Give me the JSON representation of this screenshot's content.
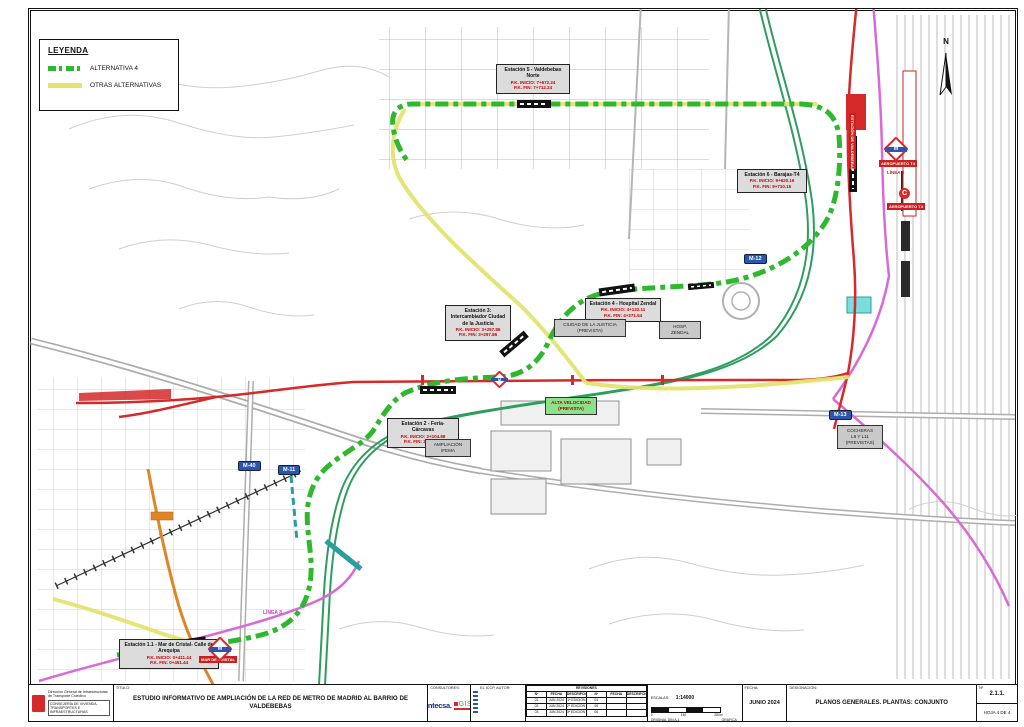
{
  "legend": {
    "title": "LEYENDA",
    "alternativa4": "ALTERNATIVA 4",
    "otras_alternativas": "OTRAS ALTERNATIVAS"
  },
  "stations": {
    "s1": {
      "title": "Estación 1.1 - Mar de Cristal- Calle de Arequipa",
      "pk_inicio": "P.K. INICIO: 0+411.44",
      "pk_fin": "P.K. FIN: 0+451.44"
    },
    "s2": {
      "title": "Estación 2 - Feria-Cárcavas",
      "pk_inicio": "P.K. INICIO: 2+104.88",
      "pk_fin": "P.K. FIN: 2+144.88"
    },
    "s3": {
      "title": "Estación 3: Intercambiador Ciudad de la Justicia",
      "pk_inicio": "P.K. INICIO: 3+257.86",
      "pk_fin": "P.K. FIN: 3+297.86"
    },
    "s4": {
      "title": "Estación 4 - Hospital Zendal",
      "pk_inicio": "P.K. INICIO: 4+132.11",
      "pk_fin": "P.K. FIN: 4+271.54"
    },
    "s5": {
      "title": "Estación 5 - Valdebebas Norte",
      "pk_inicio": "P.K. INICIO: 7+672.24",
      "pk_fin": "P.K. FIN: 7+712.24"
    },
    "s6": {
      "title": "Estación 6 - Barajas-T4",
      "pk_inicio": "P.K. INICIO: 9+620.16",
      "pk_fin": "P.K. FIN: 9+710.16"
    }
  },
  "info_boxes": {
    "ciudad_justicia": {
      "l1": "CIUDAD DE LA JUSTICIA",
      "l2": "(PREVISTA)"
    },
    "hosp_zendal": {
      "l1": "HOSP.",
      "l2": "ZENDAL"
    },
    "alta_velocidad": {
      "l1": "ALTA VELOCIDAD",
      "l2": "(PREVISTA)"
    },
    "ampliacion_ifema": {
      "l1": "AMPLIACIÓN",
      "l2": "IFEMA"
    },
    "cocheras": {
      "l1": "COCHERAS",
      "l2": "L8 Y L11",
      "l3": "(PREVISTAS)"
    }
  },
  "badges": {
    "m40": "M-40",
    "m11": "M-11",
    "m12": "M-12",
    "m13": "M-13"
  },
  "map_labels": {
    "linea8_left": "LÍNEA 8",
    "linea8_right": "LÍNEA 8",
    "aeropuerto_t4_metro": "AEROPUERTO T4",
    "aeropuerto_t4_cercanias": "AEROPUERTO T4",
    "mar_de_cristal": "MAR DE CRISTAL",
    "estacion_valdebebas": "ESTACIÓN DE VALDEBEBAS",
    "compass_north": "N",
    "metro_logo_letter": "M",
    "cercanias_logo_letter": "C"
  },
  "title_block": {
    "org_line1": "Dirección General de Infraestructuras de Transporte Colectivo",
    "org_line2": "CONSEJERÍA DE VIVIENDA, TRANSPORTES E INFRAESTRUCTURAS",
    "titulo_label": "TÍTULO:",
    "titulo": "ESTUDIO INFORMATIVO DE AMPLIACIÓN DE LA RED DE METRO DE MADRID AL BARRIO DE VALDEBEBAS",
    "consultores_label": "CONSULTORES:",
    "consultor1": "intecsa.",
    "consultor2": "GIS",
    "autor_label": "EL ICCP, AUTOR:",
    "revisiones": {
      "title": "REVISIONES",
      "headers": [
        "Nº",
        "FECHA",
        "DESCRIPCIÓN",
        "Nº",
        "FECHA",
        "DESCRIPCIÓN"
      ],
      "rows": [
        [
          "01",
          "JUN 2024",
          "1ª EDICIÓN",
          "04",
          "",
          ""
        ],
        [
          "02",
          "JUN 2024",
          "2ª EDICIÓN (TRAS SUPERVISIÓN)",
          "05",
          "",
          ""
        ],
        [
          "03",
          "JUN 2024",
          "3ª EDICIÓN (TRAS SUPERVISIÓN)",
          "06",
          "",
          ""
        ]
      ]
    },
    "escalas_label": "ESCALAS:",
    "escala": "1:14000",
    "scale_ticks": [
      "0",
      "140",
      "280m"
    ],
    "original": "ORIGINAL DIN A-1",
    "grafica": "GRÁFICA",
    "fecha_label": "FECHA:",
    "fecha": "JUNIO 2024",
    "designacion_label": "DESIGNACIÓN:",
    "designacion": "PLANOS GENERALES. PLANTAS: CONJUNTO",
    "num_label": "Nº",
    "num": "2.1.1.",
    "hoja": "HOJA 4 DE 4"
  },
  "colors": {
    "alternativa4_green": "#2eb82e",
    "otras_alternativas_yellow": "#e3e370",
    "metro_red": "#d42a2a",
    "cercanias_green": "#2d9e5e",
    "linea8_magenta": "#d86ad8",
    "orange_line": "#e08428",
    "teal_line": "#2a9d9d",
    "badge_blue": "#2a55b0"
  }
}
